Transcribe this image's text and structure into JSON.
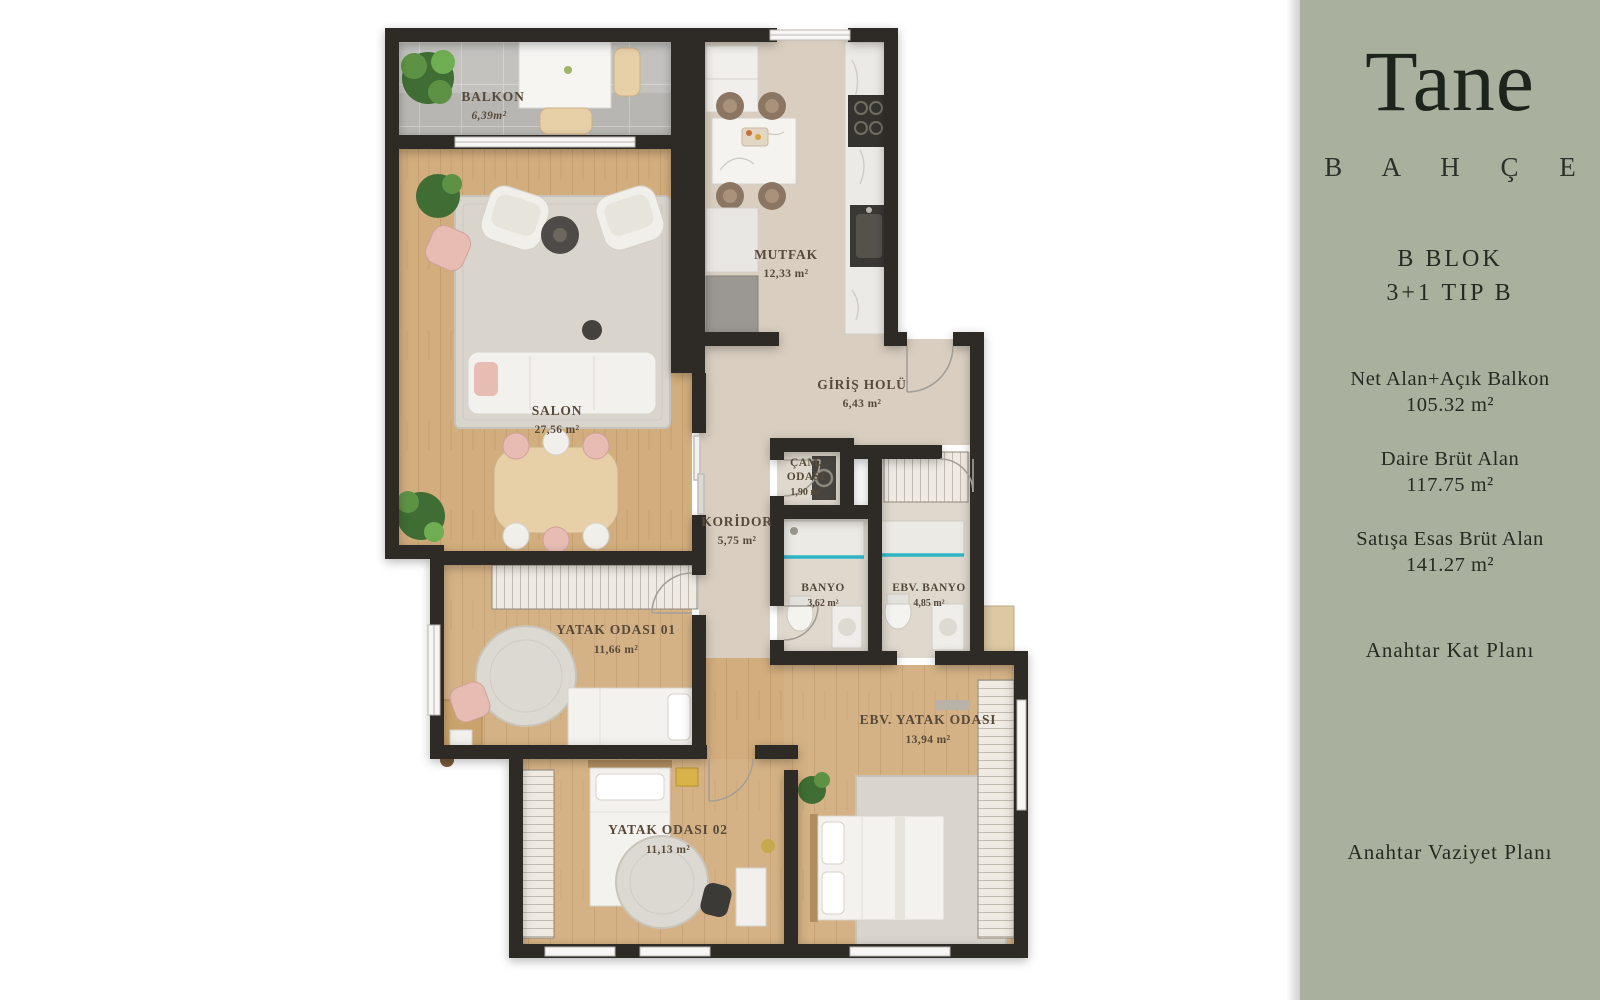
{
  "sidebar": {
    "bg_color": "#a9b19e",
    "logo": "Tane",
    "brand_sub": "B A H Ç E",
    "block": "B BLOK",
    "unit_type": "3+1 TIP B",
    "stats": [
      {
        "label": "Net Alan+Açık Balkon",
        "value": "105.32 m²"
      },
      {
        "label": "Daire Brüt Alan",
        "value": "117.75 m²"
      },
      {
        "label": "Satışa Esas Brüt Alan",
        "value": "141.27 m²"
      }
    ],
    "key_plan_label": "Anahtar Kat Planı",
    "site_plan_label": "Anahtar Vaziyet Planı"
  },
  "plan": {
    "wall_color": "#2e2b27",
    "wood_color": "#d2ad7d",
    "accent_teal": "#2fb6c6",
    "rooms": [
      {
        "name": "BALKON",
        "area": "6,39m²"
      },
      {
        "name": "SALON",
        "area": "27,56 m²"
      },
      {
        "name": "MUTFAK",
        "area": "12,33 m²"
      },
      {
        "name": "GİRİŞ HOLÜ",
        "area": "6,43 m²"
      },
      {
        "name": "ÇAM. ODASI",
        "line1": "ÇAM.",
        "line2": "ODASI",
        "area": "1,90 m²"
      },
      {
        "name": "KORİDOR",
        "area": "5,75 m²"
      },
      {
        "name": "BANYO",
        "area": "3,62 m²"
      },
      {
        "name": "EBV. BANYO",
        "area": "4,85 m²"
      },
      {
        "name": "YATAK ODASI 01",
        "area": "11,66 m²"
      },
      {
        "name": "EBV. YATAK ODASI",
        "area": "13,94 m²"
      },
      {
        "name": "YATAK ODASI 02",
        "area": "11,13 m²"
      }
    ]
  }
}
